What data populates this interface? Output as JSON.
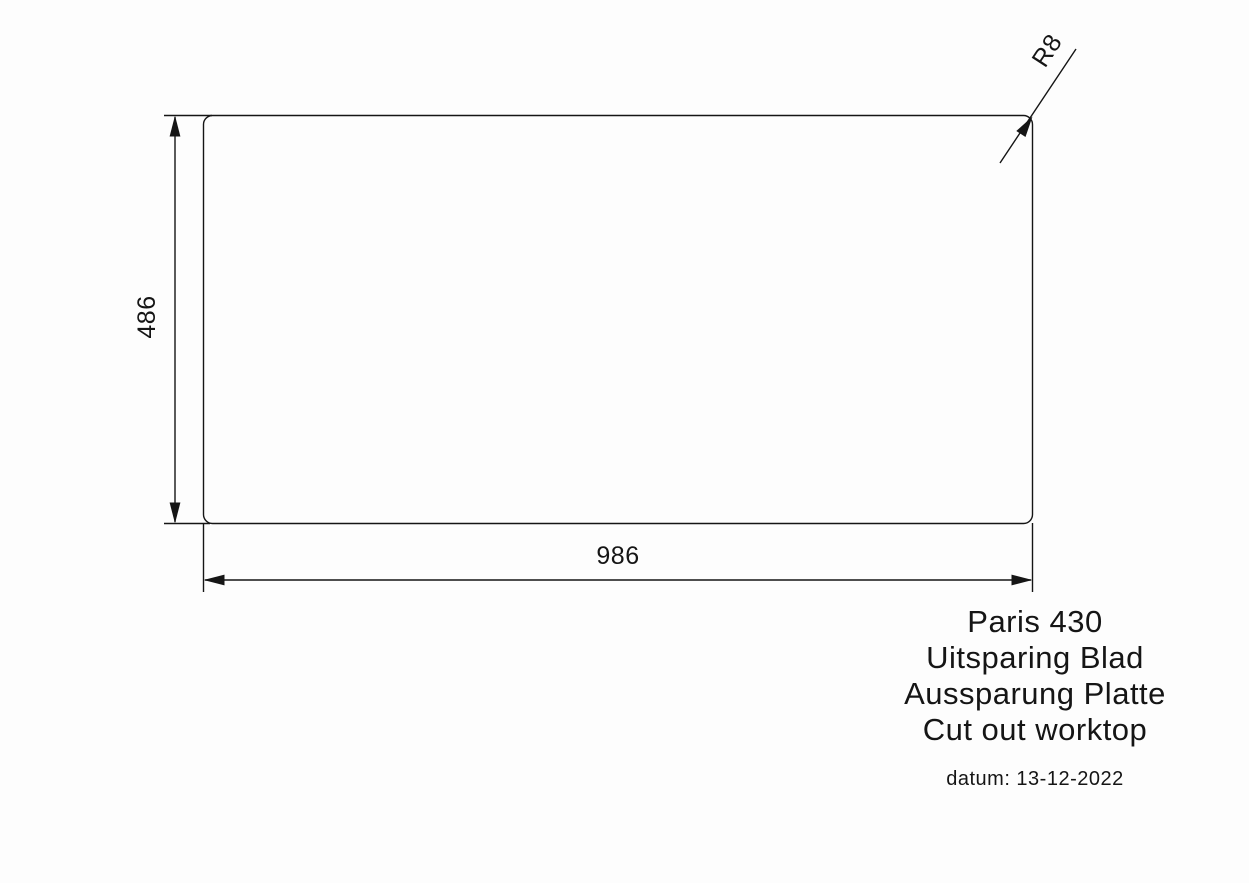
{
  "drawing": {
    "width_label": "986",
    "height_label": "486",
    "radius_label": "R8"
  },
  "title_block": {
    "lines": [
      "Paris 430",
      "Uitsparing Blad",
      "Aussparung Platte",
      "Cut out worktop"
    ],
    "date": "datum: 13-12-2022"
  },
  "colors": {
    "ink": "#151515",
    "background": "#fdfdfd"
  }
}
